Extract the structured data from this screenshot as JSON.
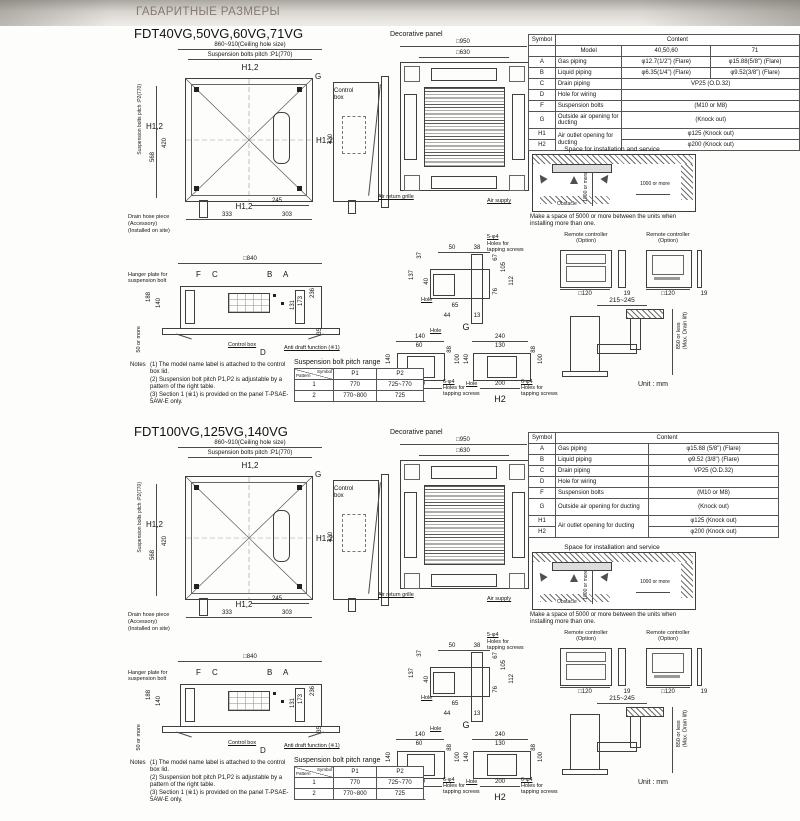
{
  "header": {
    "title": "ГАБАРИТНЫЕ РАЗМЕРЫ"
  },
  "sections": [
    {
      "title": "FDT40VG,50VG,60VG,71VG",
      "plan": {
        "ceiling_hole": "860~910(Ceiling hole size)",
        "p1": "Suspension bolts pitch :P1(770)",
        "p2": "Suspension bolts pitch :P2(770)",
        "h12": "H1,2",
        "g": "G",
        "control_box": "Control box",
        "d568": "568",
        "d420": "420",
        "d245": "245",
        "d333": "333",
        "d303": "303",
        "drain1": "Drain hose piece",
        "drain2": "(Accessory)",
        "drain3": "(Installed on site)"
      },
      "panel": {
        "label": "Decorative panel",
        "d950": "□950",
        "d630": "□630",
        "air_return": "Air return grille",
        "air_supply": "Air supply"
      },
      "bottom": {
        "d840": "□840",
        "f": "F",
        "c": "C",
        "b": "B",
        "a": "A",
        "d": "D",
        "hanger1": "Hanger plate for",
        "hanger2": "suspension bolt",
        "d188": "188",
        "d140": "140",
        "d131": "131",
        "d173": "173",
        "d236": "236",
        "d35": "35",
        "more50": "50 or more",
        "control_box": "Control box",
        "anti": "Anti draft function (※1)"
      },
      "g": {
        "d50": "50",
        "d38": "38",
        "d37": "37",
        "d137": "137",
        "d40": "40",
        "d67": "67",
        "d105": "105",
        "d112": "112",
        "d76": "76",
        "d65": "65",
        "d44": "44",
        "d13": "13",
        "hole": "Hole",
        "cap": "G",
        "s1": "5-φ4",
        "s2": "Holes for",
        "s3": "tapping screws"
      },
      "h1": {
        "cap": "H1",
        "top": "140",
        "inner": "60",
        "left": "140",
        "r1": "88",
        "r2": "100",
        "bottom": "100",
        "hole": "Hole",
        "s1": "6-φ4",
        "s2": "Holes for",
        "s3": "tapping screws"
      },
      "h2": {
        "cap": "H2",
        "top": "240",
        "inner": "130",
        "left": "140",
        "r1": "88",
        "r2": "100",
        "bottom": "200",
        "hole": "Hole",
        "s1": "6-φ4",
        "s2": "Holes for",
        "s3": "tapping screws"
      },
      "notes": {
        "label": "Notes",
        "n1": "(1) The model name label is attached to the control box lid.",
        "n2": "(2) Suspension bolt pitch P1,P2 is adjustable by a pattern of the right table.",
        "n3": "(3) Section 1 (※1) is provided on the panel T-PSAE-5AW-E only."
      },
      "pitch": {
        "title": "Suspension bolt pitch range",
        "sym": "Symbol",
        "pat": "Pattern",
        "p1": "P1",
        "p2": "P2",
        "rows": [
          {
            "n": "1",
            "p1": "770",
            "p2": "725~770"
          },
          {
            "n": "2",
            "p1": "770~800",
            "p2": "725"
          }
        ]
      },
      "table": {
        "symbol": "Symbol",
        "content": "Content",
        "model": "Model",
        "m1": "40,50,60",
        "m2": "71",
        "rows": {
          "a": {
            "s": "A",
            "l": "Gas piping",
            "v1": "φ12.7(1/2\") (Flare)",
            "v2": "φ15.88(5/8\") (Flare)"
          },
          "b": {
            "s": "B",
            "l": "Liquid piping",
            "v1": "φ6.35(1/4\") (Flare)",
            "v2": "φ9.52(3/8\") (Flare)"
          },
          "c": {
            "s": "C",
            "l": "Drain piping",
            "v": "VP25 (O.D.32)"
          },
          "d": {
            "s": "D",
            "l": "Hole for wiring",
            "v": ""
          },
          "f": {
            "s": "F",
            "l": "Suspension bolts",
            "v": "(M10 or M8)"
          },
          "g": {
            "s": "G",
            "l": "Outside air opening for ducting",
            "v": "(Knock out)"
          },
          "h1": {
            "s": "H1",
            "l": "Air outlet opening for ducting",
            "v": "φ125 (Knock out)"
          },
          "h2": {
            "s": "H2",
            "v": "φ200 (Knock out)"
          }
        }
      },
      "space": {
        "title": "Space for installation and service",
        "dim": "1000 or more",
        "obstacle": "Obstacle",
        "note": "Make a space of 5000 or more between the units when installing more than one."
      },
      "remote": {
        "label": "Remote controller (Option)",
        "d120": "□120",
        "t19": "19"
      },
      "drain": {
        "reach": "215~245",
        "lift": "850 or less\n(Max. Drain lift)",
        "unit": "Unit : mm"
      }
    },
    {
      "title": "FDT100VG,125VG,140VG",
      "plan": {
        "ceiling_hole": "860~910(Ceiling hole size)",
        "p1": "Suspension bolts pitch :P1(770)",
        "p2": "Suspension bolts pitch :P2(770)",
        "h12": "H1,2",
        "g": "G",
        "control_box": "Control box",
        "d568": "568",
        "d420": "420",
        "d245": "245",
        "d333": "333",
        "d303": "303",
        "drain1": "Drain hose piece",
        "drain2": "(Accessory)",
        "drain3": "(Installed on site)"
      },
      "panel": {
        "label": "Decorative panel",
        "d950": "□950",
        "d630": "□630",
        "air_return": "Air return grille",
        "air_supply": "Air supply"
      },
      "bottom": {
        "d840": "□840",
        "f": "F",
        "c": "C",
        "b": "B",
        "a": "A",
        "d": "D",
        "hanger1": "Hanger plate for",
        "hanger2": "suspension bolt",
        "d188": "188",
        "d140": "140",
        "d131": "131",
        "d173": "173",
        "d236": "236",
        "d35": "35",
        "more50": "50 or more",
        "control_box": "Control box",
        "anti": "Anti draft function (※1)"
      },
      "g": {
        "d50": "50",
        "d38": "38",
        "d37": "37",
        "d137": "137",
        "d40": "40",
        "d67": "67",
        "d105": "105",
        "d112": "112",
        "d76": "76",
        "d65": "65",
        "d44": "44",
        "d13": "13",
        "hole": "Hole",
        "cap": "G",
        "s1": "5-φ4",
        "s2": "Holes for",
        "s3": "tapping screws"
      },
      "h1": {
        "cap": "H1",
        "top": "140",
        "inner": "60",
        "left": "140",
        "r1": "88",
        "r2": "100",
        "bottom": "100",
        "hole": "Hole",
        "s1": "6-φ4",
        "s2": "Holes for",
        "s3": "tapping screws"
      },
      "h2": {
        "cap": "H2",
        "top": "240",
        "inner": "130",
        "left": "140",
        "r1": "88",
        "r2": "100",
        "bottom": "200",
        "hole": "Hole",
        "s1": "6-φ4",
        "s2": "Holes for",
        "s3": "tapping screws"
      },
      "notes": {
        "label": "Notes",
        "n1": "(1) The model name label is attached to the control box lid.",
        "n2": "(2) Suspension bolt pitch P1,P2 is adjustable by a pattern of the right table.",
        "n3": "(3) Section 1 (※1) is provided on the panel T-PSAE-5AW-E only."
      },
      "pitch": {
        "title": "Suspension bolt pitch range",
        "sym": "Symbol",
        "pat": "Pattern",
        "p1": "P1",
        "p2": "P2",
        "rows": [
          {
            "n": "1",
            "p1": "770",
            "p2": "725~770"
          },
          {
            "n": "2",
            "p1": "770~800",
            "p2": "725"
          }
        ]
      },
      "table": {
        "symbol": "Symbol",
        "content": "Content",
        "rows": {
          "a": {
            "s": "A",
            "l": "Gas piping",
            "v": "φ15.88 (5/8\") (Flare)"
          },
          "b": {
            "s": "B",
            "l": "Liquid piping",
            "v": "φ9.52 (3/8\") (Flare)"
          },
          "c": {
            "s": "C",
            "l": "Drain piping",
            "v": "VP25 (O.D.32)"
          },
          "d": {
            "s": "D",
            "l": "Hole for wiring",
            "v": ""
          },
          "f": {
            "s": "F",
            "l": "Suspension bolts",
            "v": "(M10 or M8)"
          },
          "g": {
            "s": "G",
            "l": "Outside air opening for ducting",
            "v": "(Knock out)"
          },
          "h1": {
            "s": "H1",
            "l": "Air outlet opening for ducting",
            "v": "φ125 (Knock out)"
          },
          "h2": {
            "s": "H2",
            "v": "φ200 (Knock out)"
          }
        }
      },
      "space": {
        "title": "Space for installation and service",
        "dim": "1000 or more",
        "obstacle": "Obstacle",
        "note": "Make a space of 5000 or more between the units when installing more than one."
      },
      "remote": {
        "label": "Remote controller (Option)",
        "d120": "□120",
        "t19": "19"
      },
      "drain": {
        "reach": "215~245",
        "lift": "850 or less\n(Max. Drain lift)",
        "unit": "Unit : mm"
      }
    }
  ]
}
